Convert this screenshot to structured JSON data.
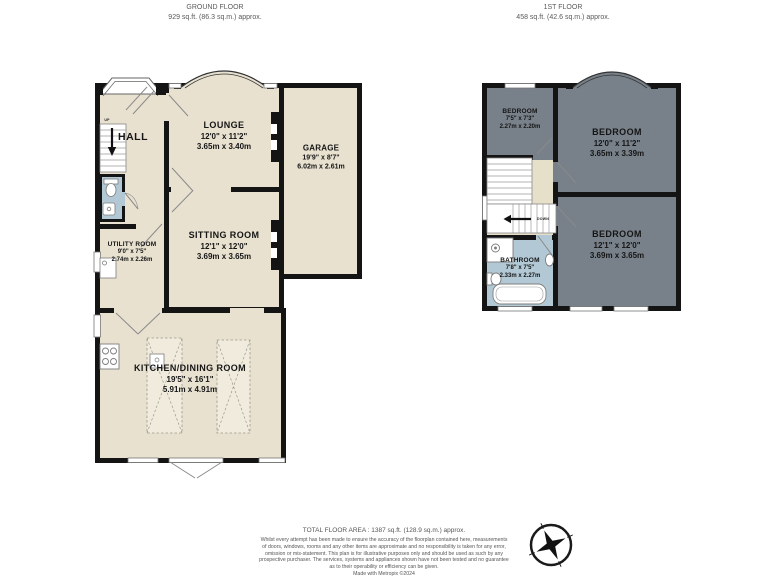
{
  "ground_floor": {
    "title": "GROUND FLOOR",
    "area": "929 sq.ft. (86.3 sq.m.) approx.",
    "hall_label": "HALL",
    "up_label": "UP",
    "rooms": {
      "lounge": {
        "name": "LOUNGE",
        "imperial": "12'0\" x 11'2\"",
        "metric": "3.65m x 3.40m"
      },
      "garage": {
        "name": "GARAGE",
        "imperial": "19'9\" x 8'7\"",
        "metric": "6.02m x 2.61m"
      },
      "sitting": {
        "name": "SITTING ROOM",
        "imperial": "12'1\" x 12'0\"",
        "metric": "3.69m x 3.65m"
      },
      "utility": {
        "name": "UTILITY ROOM",
        "imperial": "9'0\" x 7'5\"",
        "metric": "2.74m x 2.26m"
      },
      "kitchen": {
        "name": "KITCHEN/DINING ROOM",
        "imperial": "19'5\" x 16'1\"",
        "metric": "5.91m x 4.91m"
      }
    }
  },
  "first_floor": {
    "title": "1ST FLOOR",
    "area": "458 sq.ft. (42.6 sq.m.) approx.",
    "down_label": "DOWN",
    "rooms": {
      "bedroom_small": {
        "name": "BEDROOM",
        "imperial": "7'5\" x 7'3\"",
        "metric": "2.27m x 2.20m"
      },
      "bedroom_front": {
        "name": "BEDROOM",
        "imperial": "12'0\" x 11'2\"",
        "metric": "3.65m x 3.39m"
      },
      "bedroom_back": {
        "name": "BEDROOM",
        "imperial": "12'1\" x 12'0\"",
        "metric": "3.69m x 3.65m"
      },
      "bathroom": {
        "name": "BATHROOM",
        "imperial": "7'8\" x 7'5\"",
        "metric": "2.33m x 2.27m"
      }
    }
  },
  "footer": {
    "total_area": "TOTAL FLOOR AREA : 1387 sq.ft. (128.9 sq.m.) approx.",
    "disclaimer": "Whilst every attempt has been made to ensure the accuracy of the floorplan contained here, measurements\nof doors, windows, rooms and any other items are approximate and no responsibility is taken for any error,\nomission or mis-statement. This plan is for illustrative purposes only and should be used as such by any\nprospective purchaser. The services, systems and appliances shown have not been tested and no guarantee\nas to their operability or efficiency can be given.\nMade with Metropix ©2024"
  },
  "colors": {
    "wall": "#141414",
    "floor_beige": "#e8e1d0",
    "floor_gray": "#788089",
    "floor_blue": "#b2c8d5",
    "floor_landing": "#e6dfca"
  }
}
